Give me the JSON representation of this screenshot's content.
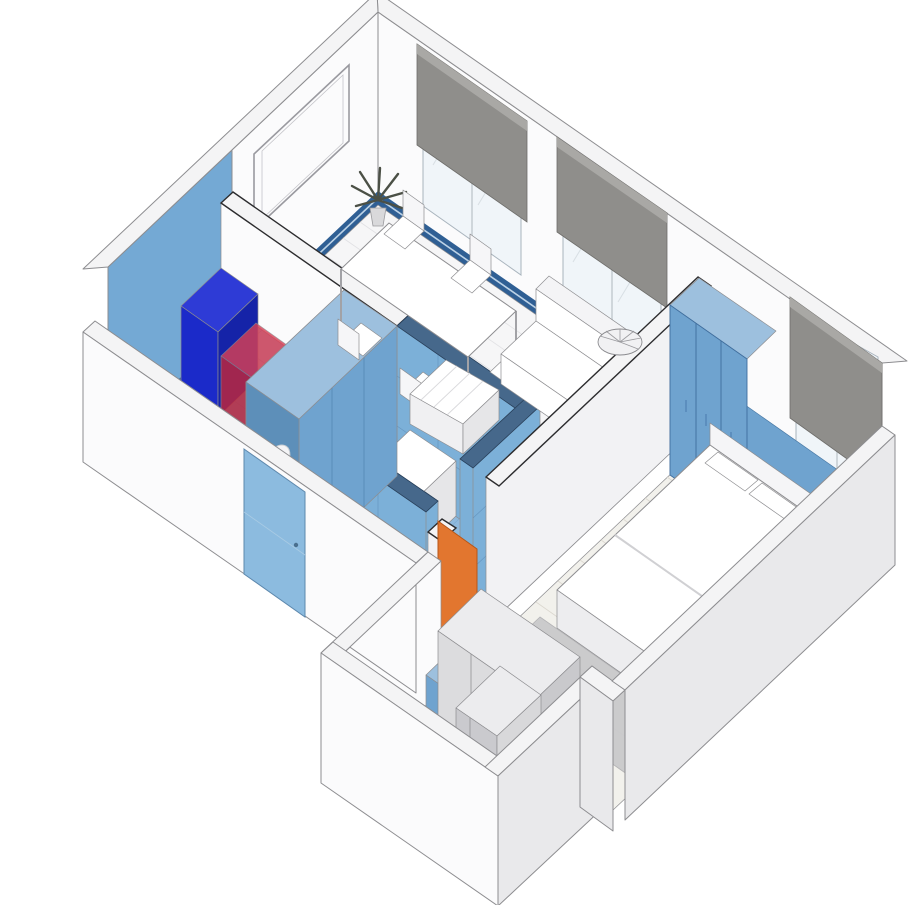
{
  "scene": {
    "kind": "isometric-apartment-floor-plan",
    "view": "axonometric cutaway, walls sectioned, no text labels"
  },
  "colors": {
    "bg": "#ffffff",
    "wall_face": "#fbfbfc",
    "wall_top": "#f4f4f5",
    "wall_side": "#e9e9eb",
    "outline": "#8d8d90",
    "plank_floor": "#f6f6f7",
    "plank_line": "#e1e1e4",
    "wood_floor": "#f2f1ec",
    "wood_line": "#dbd7cf",
    "tile_wall": "#7cb0d8",
    "tile_line": "#5b89b4",
    "tile_cap": "#46688b",
    "tile_floor": "#8fb9dc",
    "tile_floor_line": "#6b9cc4",
    "accent_wall": "#74a9d4",
    "cabinet_blue": "#6fa3cf",
    "cabinet_blue_dark": "#5d8fb9",
    "cabinet_blue_side": "#54809f",
    "cabinet_top": "#9dc0de",
    "baseboard_blue": "#2f5f94",
    "navy": "#1b2ac9",
    "navy_dark": "#1523a8",
    "navy_top": "#2e3bd6",
    "red_box": "#c0273c",
    "orange": "#e2762f",
    "rust": "#a64a17",
    "entry_door": "#8cbbdf",
    "blind": "#8f8e8b",
    "blind_roll": "#a9a8a5",
    "gray_unit": "#dcdcde",
    "gray_unit_side": "#c9c9cc",
    "gray_unit_top": "#ececee",
    "rug_gray": "#c9c9cb",
    "white_furn": "#ffffff",
    "plant_green": "#4b5046"
  },
  "rooms": [
    {
      "name": "living-dining-room",
      "items": [
        "window-1",
        "window-2",
        "roller-blind-1",
        "roller-blind-2",
        "picture-frame",
        "plant",
        "dining-table",
        "chairs",
        "sofa",
        "ottoman",
        "blue-baseboard"
      ]
    },
    {
      "name": "kitchen",
      "items": [
        "accent-blue-wall",
        "tiled-counter",
        "sink",
        "faucet",
        "navy-cabinet",
        "red-translucent-box",
        "blue-tile-floor"
      ]
    },
    {
      "name": "bathroom-1",
      "items": [
        "blue-tile-walls",
        "oval-mirror",
        "towel-hook",
        "washing-machine",
        "toilet",
        "orange-door"
      ]
    },
    {
      "name": "bedroom",
      "items": [
        "window-3",
        "roller-blind-3",
        "blue-wainscot",
        "paneled-blue-wardrobe",
        "bed",
        "pillows",
        "gray-rug",
        "round-fan-chair"
      ]
    },
    {
      "name": "hallway",
      "items": [
        "gray-wardrobe",
        "blue-bench",
        "wood-floor"
      ]
    },
    {
      "name": "bathroom-2",
      "items": [
        "rust-floor",
        "toilet",
        "shower-enclosure",
        "radiator"
      ]
    },
    {
      "name": "exterior",
      "items": [
        "white-shell-walls",
        "entrance-door"
      ]
    }
  ]
}
